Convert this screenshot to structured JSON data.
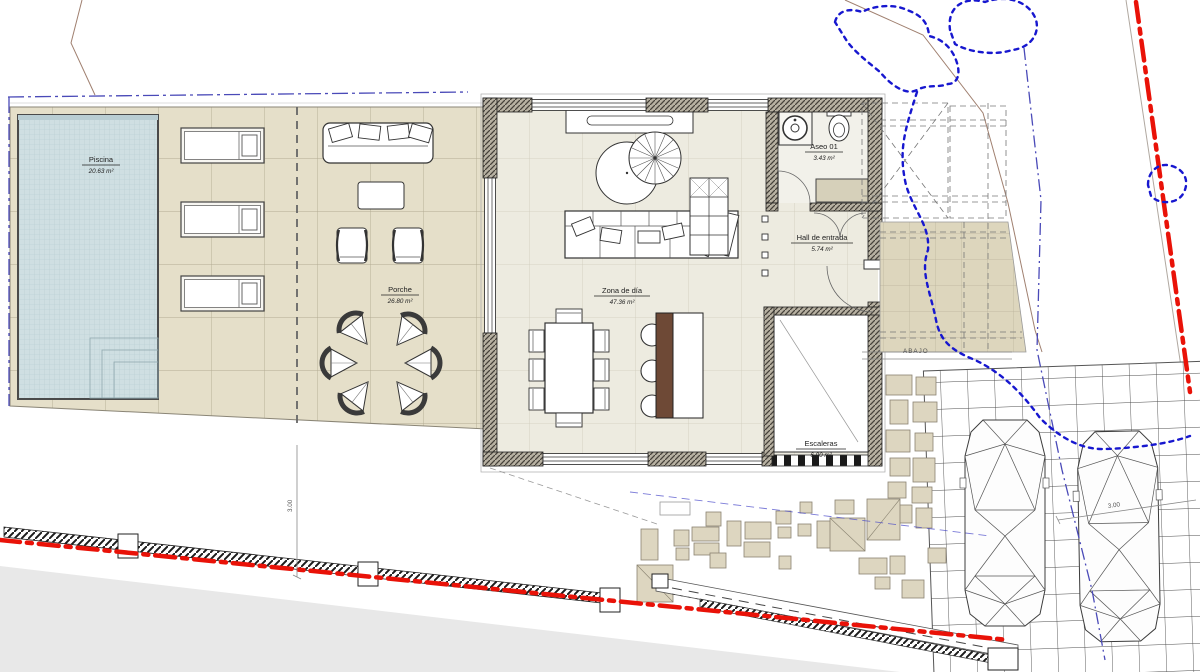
{
  "plan": {
    "title": "Planta baja - vivienda unifamiliar",
    "rooms": {
      "piscina": {
        "name": "Piscina",
        "area": "20.63 m²"
      },
      "porche": {
        "name": "Porche",
        "area": "26.80 m²"
      },
      "zona_de_dia": {
        "name": "Zona de día",
        "area": "47.36 m²"
      },
      "aseo": {
        "name": "Aseo 01",
        "area": "3.43 m²"
      },
      "hall": {
        "name": "Hall de entrada",
        "area": "5.74 m²"
      },
      "escaleras": {
        "name": "Escaleras",
        "area": "6.00 m²"
      }
    },
    "annotations": {
      "abajo": "ABAJO",
      "dim_fence": "3.00",
      "dim_parking": "3.00"
    },
    "colors": {
      "boundary_red": "#e91208",
      "vegetation_blue": "#1717cf",
      "paving_beige": "#e5dfc9",
      "pool_blue": "#cfdfe2",
      "island_brown": "#6e4936"
    }
  }
}
